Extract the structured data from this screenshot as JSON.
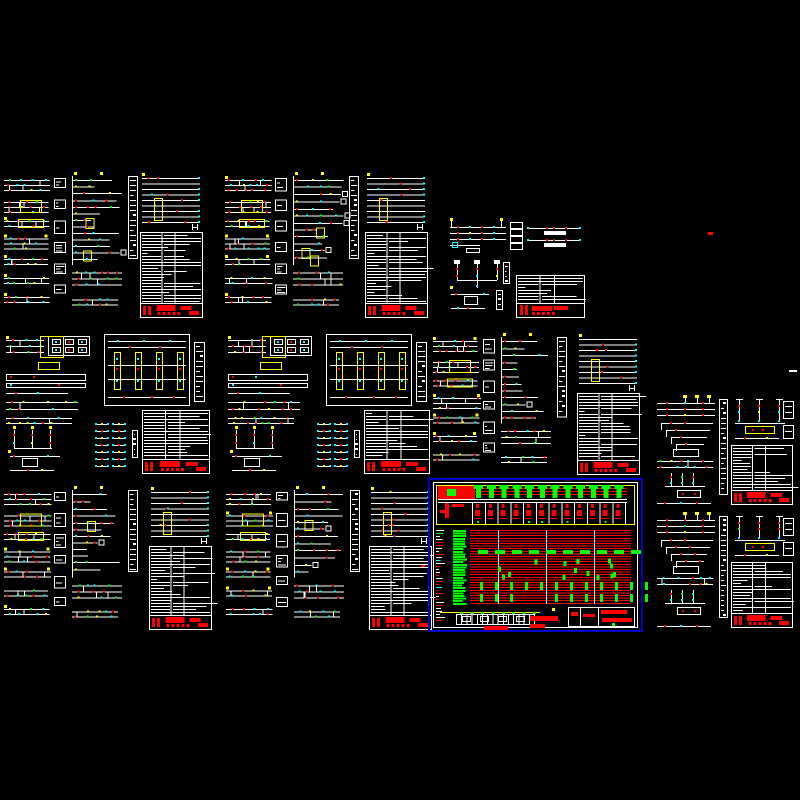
{
  "canvas": {
    "width": 800,
    "height": 800,
    "background": "#000000"
  },
  "palette": {
    "line": "#FFFFFF",
    "red": "#FF0000",
    "cyan": "#00FFFF",
    "yellow": "#FFFF00",
    "green": "#00FF00",
    "sel": "#0000C8",
    "background": "#000000"
  },
  "selected_sheet": "sheet-r3c3-highlighted-distribution-table",
  "generator": {
    "bus_row_gap": 5,
    "ladder_step": 6.5,
    "table_row_step": 3,
    "highlight_columns": 12,
    "highlight_row_step": 2.6
  },
  "sheets": [
    {
      "id": "sheet-r1c1-schematic",
      "type": "fullA",
      "x": 4,
      "y": 172,
      "w": 199,
      "h": 148,
      "seed": 11
    },
    {
      "id": "sheet-r1c2-schematic",
      "type": "fullA",
      "x": 225,
      "y": 172,
      "w": 203,
      "h": 148,
      "seed": 22
    },
    {
      "id": "sheet-r1c3-schematic-small",
      "type": "smallS",
      "x": 448,
      "y": 218,
      "w": 160,
      "h": 100,
      "seed": 33
    },
    {
      "id": "sheet-r2c1-schematic",
      "type": "fullB",
      "x": 4,
      "y": 332,
      "w": 208,
      "h": 144,
      "seed": 44
    },
    {
      "id": "sheet-r2c2-schematic",
      "type": "fullB",
      "x": 226,
      "y": 332,
      "w": 206,
      "h": 144,
      "seed": 55
    },
    {
      "id": "sheet-r2c3-schematic",
      "type": "fullA",
      "x": 433,
      "y": 333,
      "w": 207,
      "h": 144,
      "seed": 66
    },
    {
      "id": "sheet-r2c4-schematic-right",
      "type": "rightS",
      "x": 655,
      "y": 395,
      "w": 140,
      "h": 112,
      "seed": 77
    },
    {
      "id": "sheet-r3c1-schematic",
      "type": "fullA",
      "x": 4,
      "y": 486,
      "w": 208,
      "h": 146,
      "seed": 88
    },
    {
      "id": "sheet-r3c2-schematic",
      "type": "fullA",
      "x": 226,
      "y": 486,
      "w": 206,
      "h": 146,
      "seed": 99
    },
    {
      "id": "sheet-r3c3-highlighted-distribution-table",
      "type": "highlight",
      "x": 428,
      "y": 478,
      "w": 215,
      "h": 154,
      "seed": 110
    },
    {
      "id": "sheet-r3c4-schematic-right",
      "type": "rightS",
      "x": 655,
      "y": 512,
      "w": 140,
      "h": 118,
      "seed": 121
    }
  ],
  "marks": [
    {
      "id": "stray-red-dash",
      "x": 708,
      "y": 232,
      "w": 5,
      "h": 3,
      "color": "red"
    },
    {
      "id": "stray-white-dash",
      "x": 789,
      "y": 370,
      "w": 8,
      "h": 2,
      "color": "line"
    },
    {
      "id": "stray-red-dot",
      "x": 421,
      "y": 565,
      "w": 4,
      "h": 2,
      "color": "red"
    }
  ]
}
